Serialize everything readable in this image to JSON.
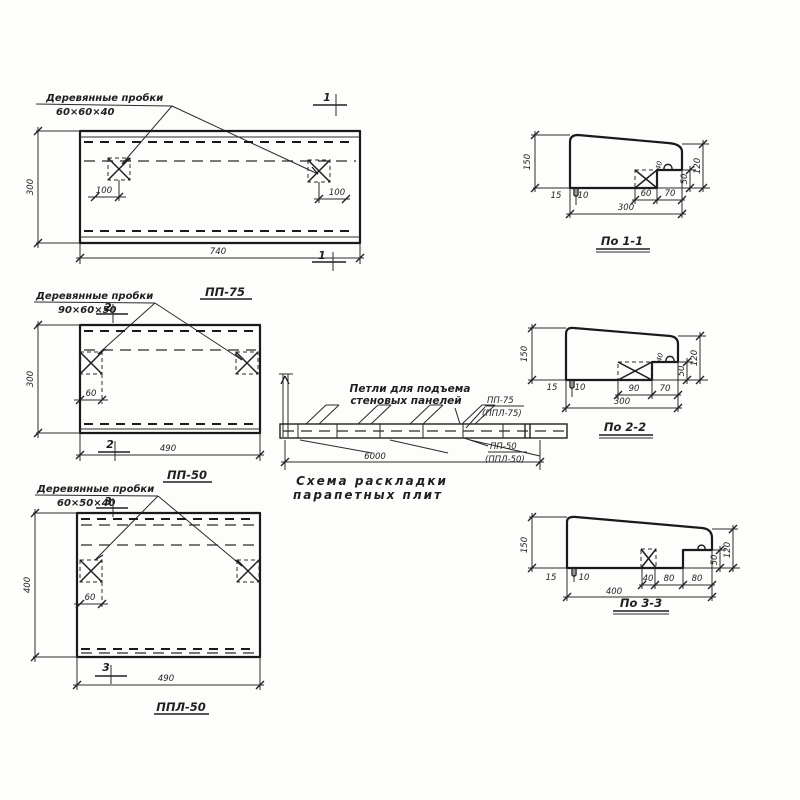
{
  "ink": "#1f1f1f",
  "paper": "#fdfdfb",
  "plans": [
    {
      "callout1": "Деревянные пробки",
      "callout2": "60×60×40",
      "mark": "1",
      "dim_height": "300",
      "dim_width": "740",
      "plug_dim_left": "100",
      "plug_dim_right": "100",
      "label": "ПП-75"
    },
    {
      "callout1": "Деревянные пробки",
      "callout2": "90×60×50",
      "mark": "2",
      "dim_height": "300",
      "dim_width": "490",
      "plug_dim": "60",
      "label": "ПП-50"
    },
    {
      "callout1": "Деревянные пробки",
      "callout2": "60×50×40",
      "mark": "3",
      "dim_height": "400",
      "dim_width": "490",
      "plug_dim": "60",
      "label": "ППЛ-50"
    }
  ],
  "scheme": {
    "note1": "Петли для подъема",
    "note2": "стеновых панелей",
    "label_top": "ПП-75",
    "label_top_alt": "(ППЛ-75)",
    "label_bottom": "ПП-50",
    "label_bottom_alt": "(ППЛ-50)",
    "dim_length": "6000",
    "caption1": "Схема раскладки",
    "caption2": "парапетных плит"
  },
  "sections": [
    {
      "label": "По 1-1",
      "dim_height": "150",
      "dim_edge": "15",
      "dim_tooth": "10",
      "dim_seg1": "60",
      "dim_seg2": "70",
      "dim_total": "300",
      "dim_right": "120",
      "dim_seat": "50",
      "dim_loop": "40"
    },
    {
      "label": "По 2-2",
      "dim_height": "150",
      "dim_edge": "15",
      "dim_tooth": "10",
      "dim_seg1": "90",
      "dim_seg2": "70",
      "dim_total": "300",
      "dim_right": "120",
      "dim_seat": "50",
      "dim_loop": "40"
    },
    {
      "label": "По 3-3",
      "dim_height": "150",
      "dim_edge": "15",
      "dim_tooth": "10",
      "dim_seg1": "40",
      "dim_seg2": "80",
      "dim_seg3": "80",
      "dim_total": "400",
      "dim_right": "120",
      "dim_seat": "50"
    }
  ]
}
